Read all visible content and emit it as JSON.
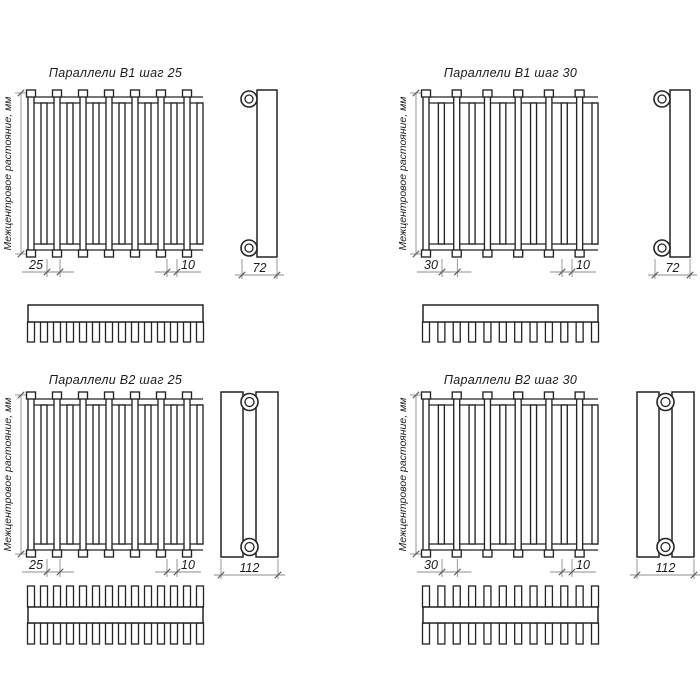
{
  "sheet": {
    "background": "#ffffff",
    "colors": {
      "line": "#242424",
      "dim": "#8c8c8c",
      "tick": "#5a5a5a",
      "text": "#1c1c1c"
    }
  },
  "shared": {
    "vertical_label": "Межцентровое растояние, мм"
  },
  "panels": [
    {
      "id": "b1-step25",
      "title": "Параллели В1 шаг 25",
      "pitch_label": "25",
      "tube_label": "10",
      "depth_label": "72",
      "tube_count": 14,
      "variant": "B1",
      "comb": "single"
    },
    {
      "id": "b1-step30",
      "title": "Параллели В1 шаг 30",
      "pitch_label": "30",
      "tube_label": "10",
      "depth_label": "72",
      "tube_count": 12,
      "variant": "B1",
      "comb": "single"
    },
    {
      "id": "b2-step25",
      "title": "Параллели В2 шаг 25",
      "pitch_label": "25",
      "tube_label": "10",
      "depth_label": "112",
      "tube_count": 14,
      "variant": "B2",
      "comb": "double"
    },
    {
      "id": "b2-step30",
      "title": "Параллели В2 шаг 30",
      "pitch_label": "30",
      "tube_label": "10",
      "depth_label": "112",
      "tube_count": 12,
      "variant": "B2",
      "comb": "double"
    }
  ]
}
